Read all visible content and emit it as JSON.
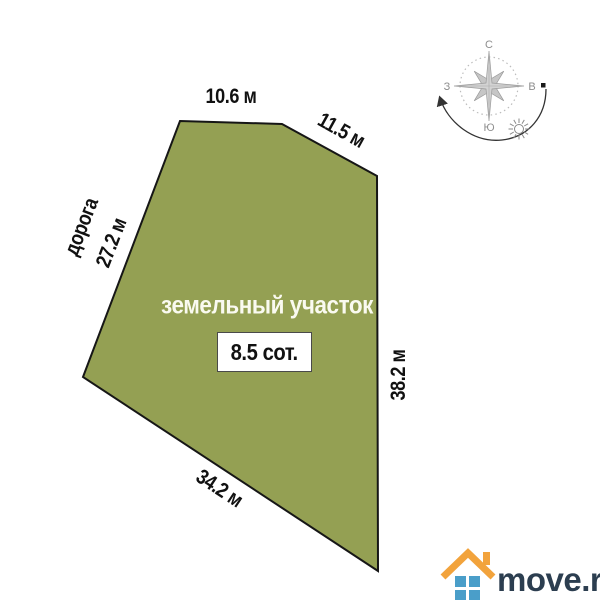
{
  "diagram": {
    "plot_label": "земельный участок",
    "area_label": "8.5 сот.",
    "plot_fill": "#94A053",
    "plot_stroke": "#161616",
    "dimensions": {
      "top": "10.6 м",
      "top_right": "11.5 м",
      "road": "дорога",
      "left": "27.2 м",
      "right": "38.2 м",
      "bottom": "34.2 м"
    }
  },
  "compass": {
    "north": "С",
    "east": "В",
    "west": "З",
    "south": "Ю"
  },
  "logo": {
    "text": "move.ru",
    "text_color": "#2C3E50",
    "roof_color": "#F2A33C",
    "squares_color": "#4A9EC9"
  }
}
